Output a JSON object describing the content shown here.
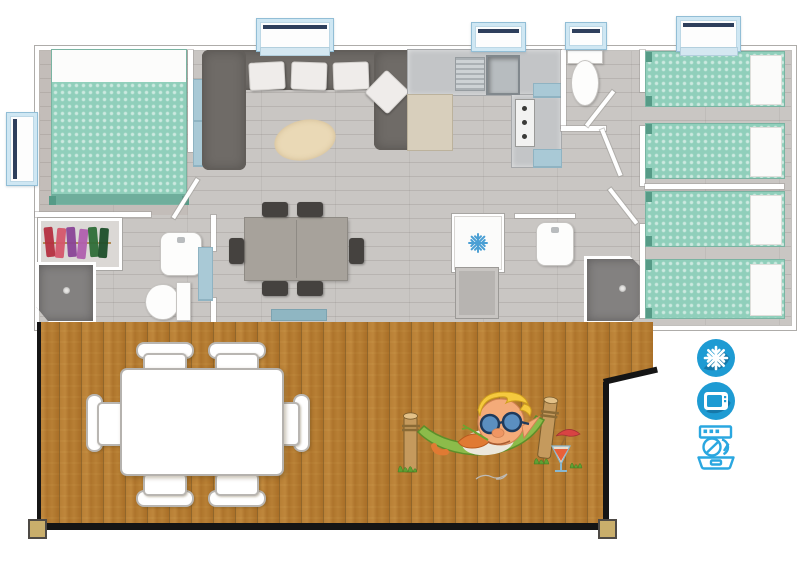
{
  "meta": {
    "description": "Top-down 3D floor plan of a holiday mobile home with a covered wooden deck, six sleeping places and amenity badges"
  },
  "floorplan": {
    "rooms": [
      {
        "name": "master-bedroom",
        "furniture": [
          "double-bed-teal",
          "wardrobe-with-clothes"
        ]
      },
      {
        "name": "bathroom-left",
        "furniture": [
          "shower",
          "washbasin",
          "toilet"
        ]
      },
      {
        "name": "living-room",
        "furniture": [
          "u-shaped-corner-sofa",
          "white-cushions",
          "oval-rug",
          "blue-tv-cabinet"
        ]
      },
      {
        "name": "dining-area",
        "furniture": [
          "table",
          "six-chairs",
          "blue-entry-mat"
        ]
      },
      {
        "name": "kitchen",
        "furniture": [
          "sink",
          "drainer",
          "cooktop",
          "bar-counter",
          "blue-accent-cabinets"
        ]
      },
      {
        "name": "wc",
        "furniture": [
          "toilet"
        ]
      },
      {
        "name": "hall",
        "furniture": [
          "fridge-with-snowflake",
          "base-cabinet"
        ]
      },
      {
        "name": "shower-room-right",
        "furniture": [
          "washbasin",
          "shower"
        ]
      },
      {
        "name": "bedroom-2",
        "furniture": [
          "single-bed-teal",
          "single-bed-teal"
        ]
      },
      {
        "name": "bedroom-3",
        "furniture": [
          "single-bed-teal",
          "single-bed-teal"
        ]
      }
    ],
    "window_count": 5,
    "deck": {
      "furniture": [
        "outdoor-table-white",
        "six-outdoor-chairs-white"
      ],
      "mascot": "elf-relaxing-in-hammock-with-sunglasses-and-cocktail",
      "posts": 2
    }
  },
  "amenities": [
    {
      "name": "air-conditioning",
      "icon": "snowflake-icon",
      "badge_shape": "circle",
      "badge_color": "#1e9bd3",
      "glyph_color": "#ffffff"
    },
    {
      "name": "television",
      "icon": "tv-icon",
      "badge_shape": "circle",
      "badge_color": "#1e9bd3",
      "glyph_color": "#ffffff"
    },
    {
      "name": "dishwasher",
      "icon": "dishwasher-icon",
      "badge_shape": "outline",
      "badge_color": "#2aa7e0",
      "glyph_color": "#2aa7e0"
    }
  ],
  "palette": {
    "bed_teal": "#90cfbb",
    "sofa_gray": "#6f6b67",
    "deck_wood": "#d6b170",
    "floor_gray": "#c9c6c3",
    "window_blue": "#cfe7f3",
    "accent_blue": "#a9c9d6",
    "fridge_snowflake": "#4a9fd4",
    "icon_blue": "#1e9bd3",
    "dishwasher_outline": "#2aa7e0"
  }
}
